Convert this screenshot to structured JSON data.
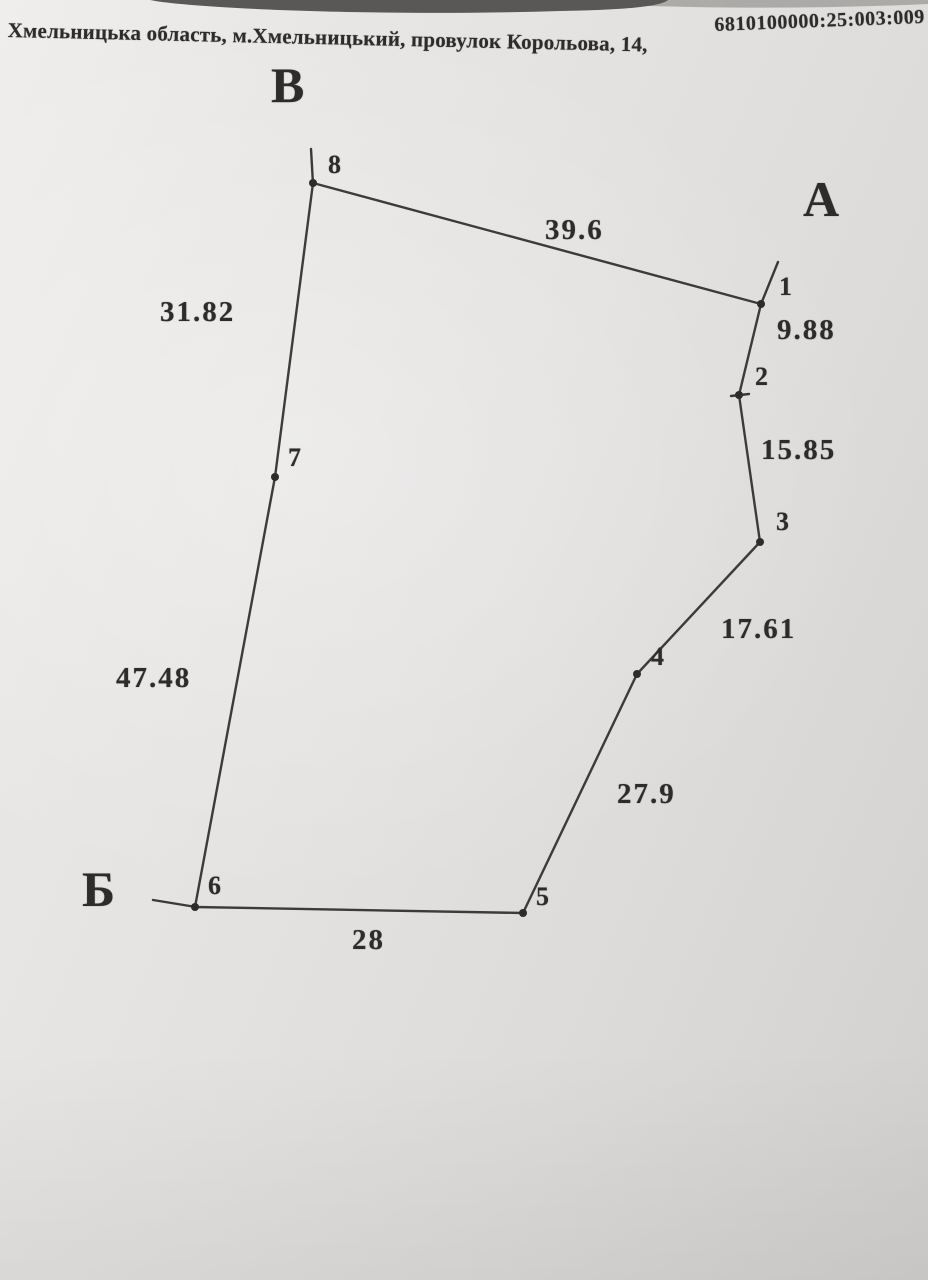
{
  "header": {
    "address": "Хмельницька область, м.Хмельницький, провулок Корольова, 14,",
    "cadastral_number": "6810100000:25:003:009"
  },
  "colors": {
    "ink": "#2e2c2a",
    "photo_background_dark": "#5a5856",
    "photo_background_light": "#9a9896"
  },
  "plan": {
    "boundary_order": [
      "8",
      "1",
      "2",
      "3",
      "4",
      "5",
      "6",
      "7"
    ],
    "vertices": [
      {
        "id": "1",
        "x": 761,
        "y": 304,
        "label_x": 779,
        "label_y": 272
      },
      {
        "id": "2",
        "x": 739,
        "y": 395,
        "label_x": 755,
        "label_y": 362
      },
      {
        "id": "3",
        "x": 760,
        "y": 542,
        "label_x": 776,
        "label_y": 507
      },
      {
        "id": "4",
        "x": 637,
        "y": 674,
        "label_x": 651,
        "label_y": 642
      },
      {
        "id": "5",
        "x": 523,
        "y": 913,
        "label_x": 536,
        "label_y": 882
      },
      {
        "id": "6",
        "x": 195,
        "y": 907,
        "label_x": 208,
        "label_y": 871
      },
      {
        "id": "7",
        "x": 275,
        "y": 477,
        "label_x": 288,
        "label_y": 443
      },
      {
        "id": "8",
        "x": 313,
        "y": 183,
        "label_x": 328,
        "label_y": 150
      }
    ],
    "edges": [
      {
        "from": "8",
        "to": "1",
        "length": "39.6",
        "label_x": 545,
        "label_y": 214
      },
      {
        "from": "1",
        "to": "2",
        "length": "9.88",
        "label_x": 777,
        "label_y": 314
      },
      {
        "from": "2",
        "to": "3",
        "length": "15.85",
        "label_x": 761,
        "label_y": 434
      },
      {
        "from": "3",
        "to": "4",
        "length": "17.61",
        "label_x": 721,
        "label_y": 613
      },
      {
        "from": "4",
        "to": "5",
        "length": "27.9",
        "label_x": 617,
        "label_y": 778
      },
      {
        "from": "5",
        "to": "6",
        "length": "28",
        "label_x": 352,
        "label_y": 924
      },
      {
        "from": "6",
        "to": "7",
        "length": "47.48",
        "label_x": 116,
        "label_y": 662
      },
      {
        "from": "7",
        "to": "8",
        "length": "31.82",
        "label_x": 160,
        "label_y": 296
      }
    ],
    "ticks": [
      {
        "x1": 311,
        "y1": 149,
        "x2": 313,
        "y2": 184
      },
      {
        "x1": 778,
        "y1": 262,
        "x2": 761,
        "y2": 304
      },
      {
        "x1": 153,
        "y1": 900,
        "x2": 196,
        "y2": 907
      },
      {
        "x1": 731,
        "y1": 396,
        "x2": 749,
        "y2": 394
      }
    ],
    "corner_labels": [
      {
        "text": "В",
        "x": 271,
        "y": 56
      },
      {
        "text": "А",
        "x": 803,
        "y": 170
      },
      {
        "text": "Б",
        "x": 82,
        "y": 860
      }
    ]
  }
}
